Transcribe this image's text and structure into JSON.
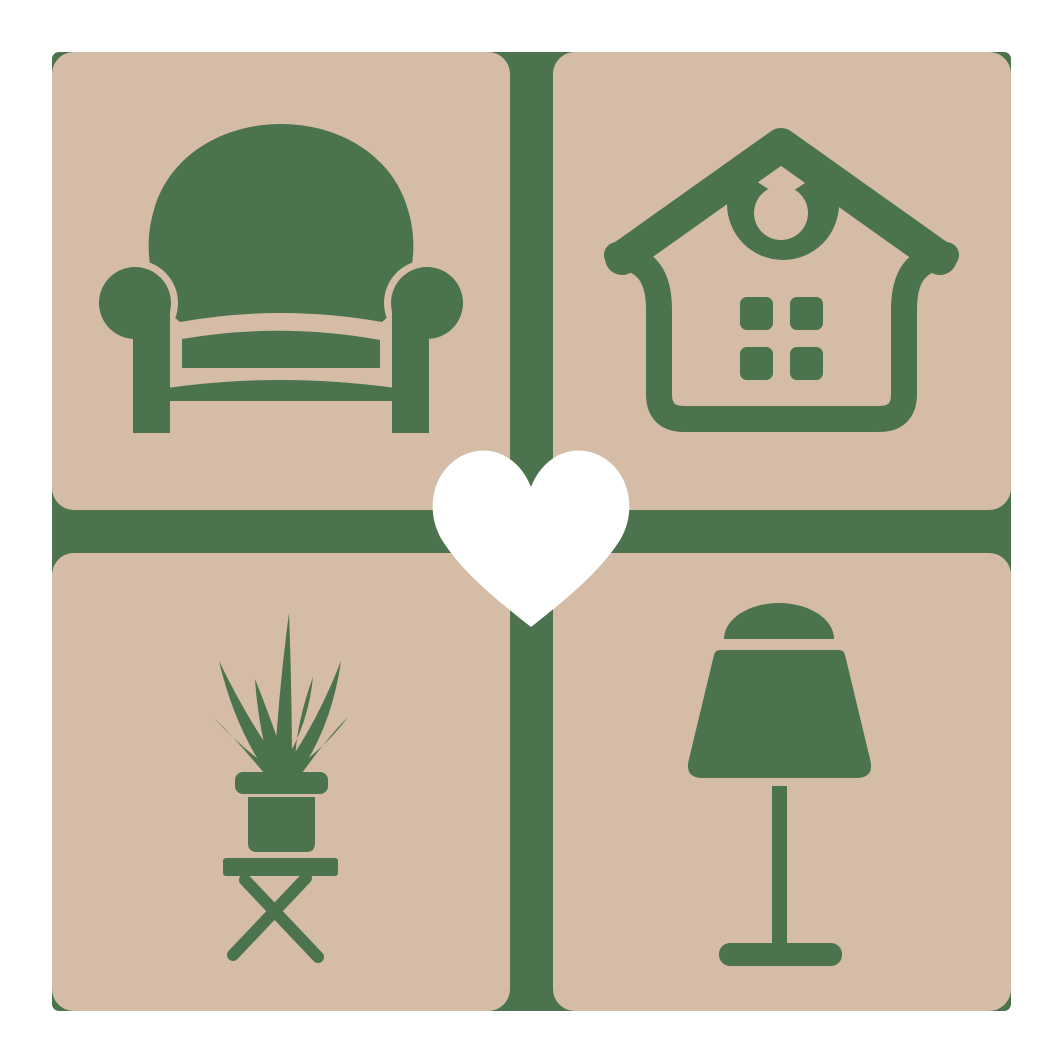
{
  "logo": {
    "name": "furniture-home-decor-logo",
    "colors": {
      "green": "#4A734E",
      "tan": "#D4BCA6",
      "heart": "#FFFFFF",
      "background": "#FFFFFF"
    },
    "grid": {
      "rows": 2,
      "columns": 2
    },
    "tiles": [
      {
        "position": "top-left",
        "icon": "armchair-icon"
      },
      {
        "position": "top-right",
        "icon": "house-icon"
      },
      {
        "position": "bottom-left",
        "icon": "potted-plant-icon"
      },
      {
        "position": "bottom-right",
        "icon": "table-lamp-icon"
      }
    ],
    "center_icon": "heart-icon"
  }
}
